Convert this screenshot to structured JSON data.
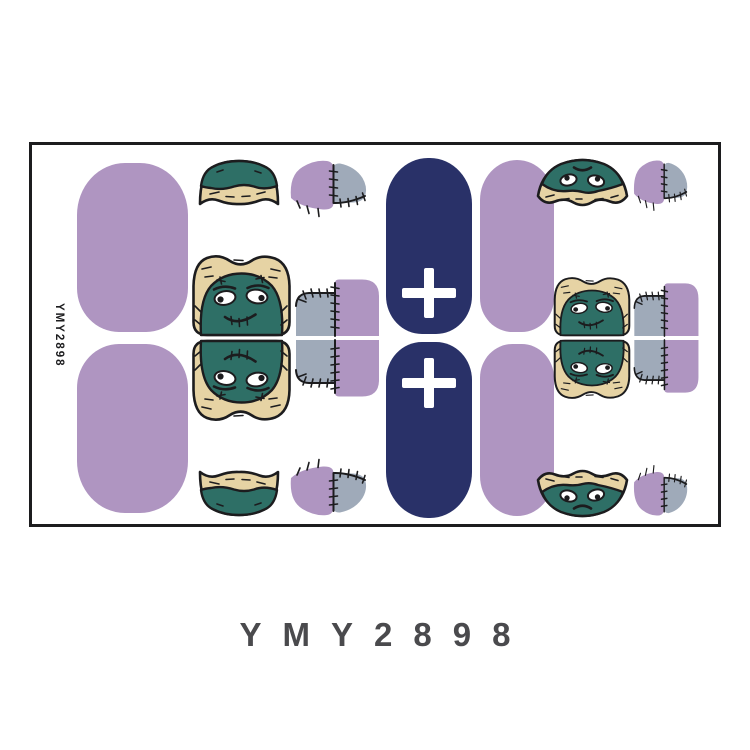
{
  "page": {
    "caption_text": "YMY2898"
  },
  "card": {
    "code_vertical": "YMY2898"
  },
  "palette": {
    "page_bg": "#FFFFFF",
    "card_bg": "#FFFFFF",
    "ink": "#1C1C1E",
    "purple": "#AF95C1",
    "navy": "#293168",
    "teal": "#2E6F66",
    "tan": "#E6D3A4",
    "gray_blue": "#9FAAB9",
    "eye_white": "#FFFFFF",
    "cross": "#FFFFFF",
    "caption_gray": "#4A4A4D"
  },
  "sheet": {
    "nail_designs": [
      {
        "name": "plain-purple-nail",
        "count": 4
      },
      {
        "name": "frankenstein-face-nail",
        "count": 8
      },
      {
        "name": "stitched-patch-nail",
        "count": 8
      },
      {
        "name": "navy-nail-with-white-cross",
        "count": 2
      }
    ]
  }
}
